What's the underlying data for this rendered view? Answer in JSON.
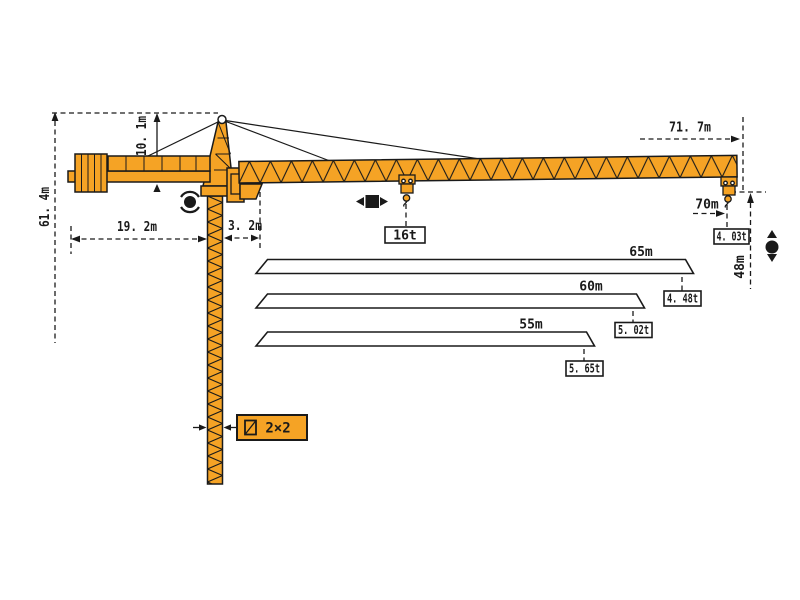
{
  "diagram_title": "Tower crane working range diagram",
  "colors": {
    "crane_fill": "#F5A325",
    "outline": "#1A1A1A",
    "background": "#FFFFFF"
  },
  "dimensions": {
    "total_height": "61. 4m",
    "head_above_jib": "10. 1m",
    "counterjib_length": "19. 2m",
    "jib_root_offset": "3. 2m",
    "overall_radius": "71. 7m",
    "tip_radius": "70m",
    "hook_height": "48m"
  },
  "loads": {
    "max_capacity": "16t",
    "tip_capacity": "4. 03t"
  },
  "mast": {
    "section_label": "2×2"
  },
  "jib_options": [
    {
      "length": "65m",
      "tip_load": "4. 48t"
    },
    {
      "length": "60m",
      "tip_load": "5. 02t"
    },
    {
      "length": "55m",
      "tip_load": "5. 65t"
    }
  ]
}
